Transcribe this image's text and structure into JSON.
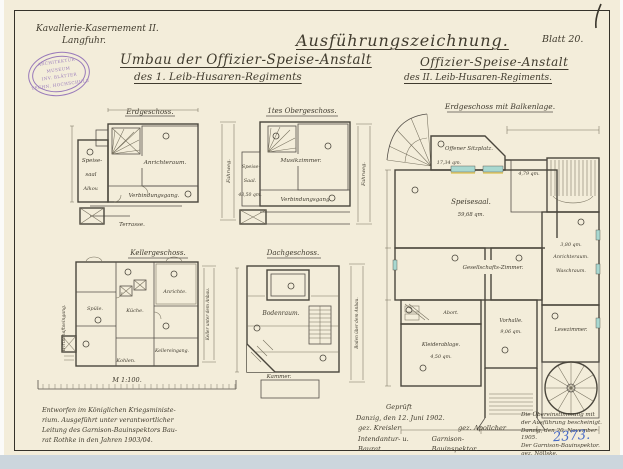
{
  "palette": {
    "paper": "#f3edda",
    "ink": "#403b2e",
    "frame": "#35322a",
    "stamp": "#8a67b5",
    "registry_blue": "#4568c6",
    "scan_strip": "#ccd6dd",
    "window_teal": "#a8d8d0",
    "window_yellow": "#d9c14d"
  },
  "header": {
    "site_line1": "Kavallerie-Kasernement II.",
    "site_line2": "Langfuhr.",
    "main_title": "Ausführungszeichnung.",
    "blatt": "Blatt 20.",
    "left_title": "Umbau der Offizier-Speise-Anstalt",
    "left_subtitle": "des 1. Leib-Husaren-Regiments",
    "right_title": "Offizier-Speise-Anstalt",
    "right_subtitle": "des II. Leib-Husaren-Regiments."
  },
  "stamp": {
    "line1": "ARCHITEKTUR-MUSEUM",
    "line2": "INV. BLÄTTER",
    "line3": "TECHN. HOCHSCHULE"
  },
  "plans": {
    "p1": {
      "title": "Erdgeschoss.",
      "rooms": {
        "speise": "Speise-",
        "saal": "saal",
        "alkov": "Alkov.",
        "anrichte": "Anrichteraum.",
        "gang": "Verbindungsgang.",
        "terrasse": "Terrasse.",
        "side": "Fahrweg."
      }
    },
    "p2": {
      "title": "1tes Obergeschoss.",
      "rooms": {
        "speise": "Speise-",
        "saal": "Saal.",
        "area": "43,50 qm.",
        "musik": "Musikzimmer.",
        "gang": "Verbindungsgang.",
        "side": "Fahrweg."
      }
    },
    "p3": {
      "title": "Kellergeschoss.",
      "rooms": {
        "spuele": "Spüle.",
        "kueche": "Küche.",
        "anrichte": "Anrichte.",
        "kellereingang": "Kellereingang.",
        "kohlen": "Kohlen.",
        "side_left": "Wirtschaftseingang.",
        "side_right": "Keller unter dem Anbau."
      }
    },
    "p4": {
      "title": "Dachgeschoss.",
      "rooms": {
        "boden": "Bodenraum.",
        "kammer": "Kammer.",
        "side": "Boden über dem Anbau."
      }
    },
    "p5": {
      "title": "Erdgeschoss mit Balkenlage.",
      "rooms": {
        "sitzplatz": "Offener Sitzplatz.",
        "sitzplatz_area": "17,34 qm.",
        "speisesaal": "Speisesaal.",
        "speisesaal_area": "59,68 qm.",
        "vorraum_area": "4,79 qm.",
        "anrichte_area": "3,80 qm.",
        "anrichte": "Anrichteraum.",
        "wasch": "Waschraum.",
        "gesellschaft": "Gesellschafts-Zimmer.",
        "abort": "Abort.",
        "kleider": "Kleiderablage.",
        "kleider_area": "4,50 qm.",
        "vorhalle": "Vorhalle.",
        "vorhalle_area": "9,06 qm.",
        "lese": "Lesezimmer."
      }
    }
  },
  "scale": {
    "label": "M 1:100."
  },
  "footer": {
    "note_left": [
      "Entworfen im Königlichen Kriegsministe-",
      "rium. Ausgeführt unter verantwortlicher",
      "Leitung des Garnison-Bauinspektors Bau-",
      "rat Rothke in den Jahren 1903/04."
    ],
    "approval": {
      "l1": "Geprüft",
      "l2": "Danzig, den 12. Juni 1902.",
      "sig1": "gez. Kreisler",
      "sig2": "gez. Apollcher",
      "t1": "Intendantur- u. Baurat.",
      "t2": "Garnison-Bauinspektor."
    },
    "cert": [
      "Die Übereinstimmung mit",
      "der Ausführung bescheinigt.",
      "Danzig, den 20. November 1905.",
      "Der Garnison-Bauinspektor.",
      "gez. Nöllske."
    ],
    "registry_number": "2373."
  }
}
